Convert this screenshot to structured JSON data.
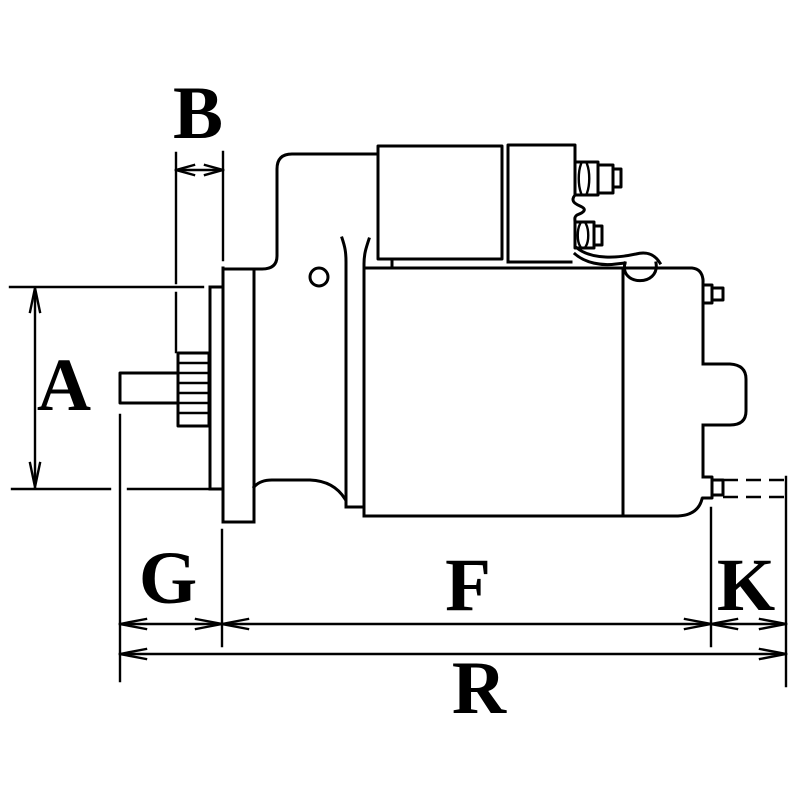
{
  "canvas": {
    "background": "#ffffff",
    "stroke_color": "#000000"
  },
  "drawing": {
    "type": "technical-dimension-drawing",
    "subject": "starter-motor-side-view"
  },
  "dimension_labels": {
    "A": "A",
    "B": "B",
    "G": "G",
    "F": "F",
    "K": "K",
    "R": "R"
  }
}
